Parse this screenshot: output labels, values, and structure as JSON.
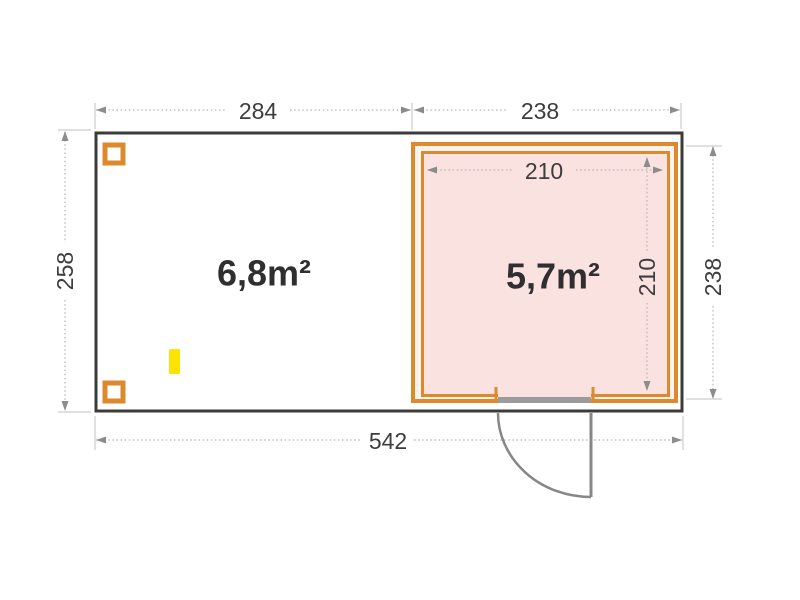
{
  "plan": {
    "type": "floor-plan",
    "areas": {
      "left_label": "6,8m²",
      "right_label": "5,7m²"
    },
    "dims": {
      "top_left": "284",
      "top_right": "238",
      "left": "258",
      "right": "238",
      "inner_width": "210",
      "inner_height": "210",
      "total_width": "542"
    },
    "colors": {
      "wall_orange": "#dd8a2e",
      "room_fill": "#f9e2e0",
      "wall_gap_fill": "#fdf3ee",
      "outline_dark": "#3b3b3b",
      "marker_yellow": "#fce303",
      "door_gray": "#878787",
      "dimension_gray": "#b5b5b5"
    }
  }
}
